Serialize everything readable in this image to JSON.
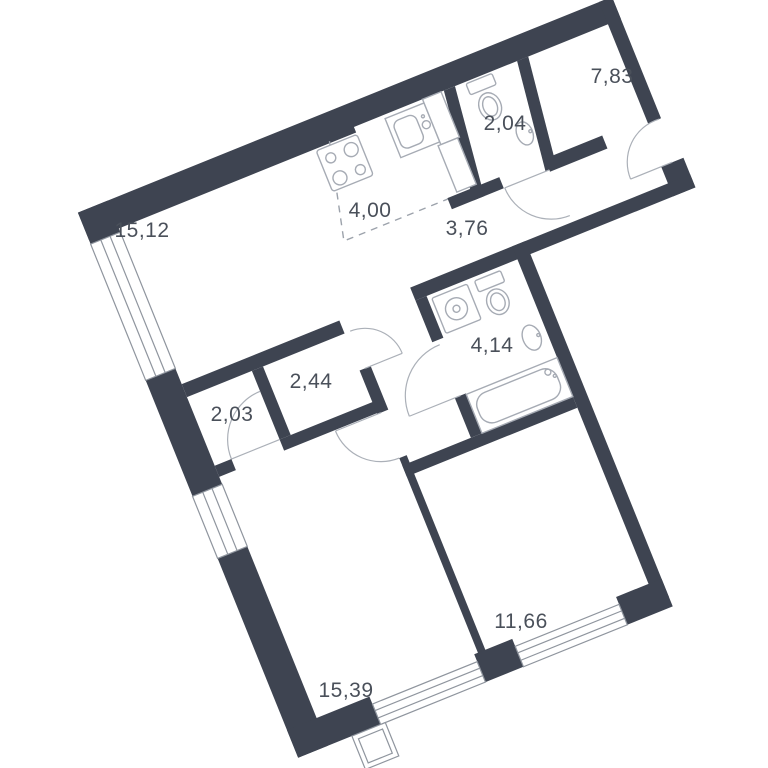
{
  "plan": {
    "type": "apartment-floor-plan",
    "rotation_deg": -22,
    "background": "#FFFFFF",
    "total_rooms": 10,
    "area_unit_format": "comma-decimal"
  },
  "colors": {
    "wall": "#3E4451",
    "fixture_line": "#A6ABB4",
    "door_line": "#ABB0B8",
    "dash_line": "#9CA2AB",
    "window_line": "#8F959E",
    "label_text": "#4A505A"
  },
  "rooms": [
    {
      "id": "living-room",
      "area_label": "15,12",
      "label_pos": {
        "x": 142,
        "y": 231
      }
    },
    {
      "id": "kitchen-zone",
      "area_label": "4,00",
      "label_pos": {
        "x": 370,
        "y": 211
      }
    },
    {
      "id": "hallway",
      "area_label": "3,76",
      "label_pos": {
        "x": 467,
        "y": 229
      }
    },
    {
      "id": "wc",
      "area_label": "2,04",
      "label_pos": {
        "x": 505,
        "y": 124
      }
    },
    {
      "id": "bedroom-top",
      "area_label": "7,83",
      "label_pos": {
        "x": 612,
        "y": 77
      }
    },
    {
      "id": "wardrobe-left",
      "area_label": "2,03",
      "label_pos": {
        "x": 232,
        "y": 415
      }
    },
    {
      "id": "wardrobe-right",
      "area_label": "2,44",
      "label_pos": {
        "x": 311,
        "y": 382
      }
    },
    {
      "id": "bathroom",
      "area_label": "4,14",
      "label_pos": {
        "x": 492,
        "y": 346
      }
    },
    {
      "id": "bedroom-bottom",
      "area_label": "15,39",
      "label_pos": {
        "x": 346,
        "y": 691
      }
    },
    {
      "id": "room-bottom-right",
      "area_label": "11,66",
      "label_pos": {
        "x": 521,
        "y": 622
      }
    }
  ],
  "fixtures": [
    {
      "id": "stove-icon"
    },
    {
      "id": "kitchen-sink-icon"
    },
    {
      "id": "kitchen-cabinet-icon"
    },
    {
      "id": "wc-toilet-icon"
    },
    {
      "id": "wc-washbasin-icon"
    },
    {
      "id": "washing-machine-icon"
    },
    {
      "id": "bathroom-toilet-icon"
    },
    {
      "id": "bathroom-washbasin-icon"
    },
    {
      "id": "bathtub-icon"
    },
    {
      "id": "balcony-sill"
    }
  ],
  "openings": {
    "exterior_windows": 4,
    "entrance_door": 1,
    "interior_doors": 5
  }
}
